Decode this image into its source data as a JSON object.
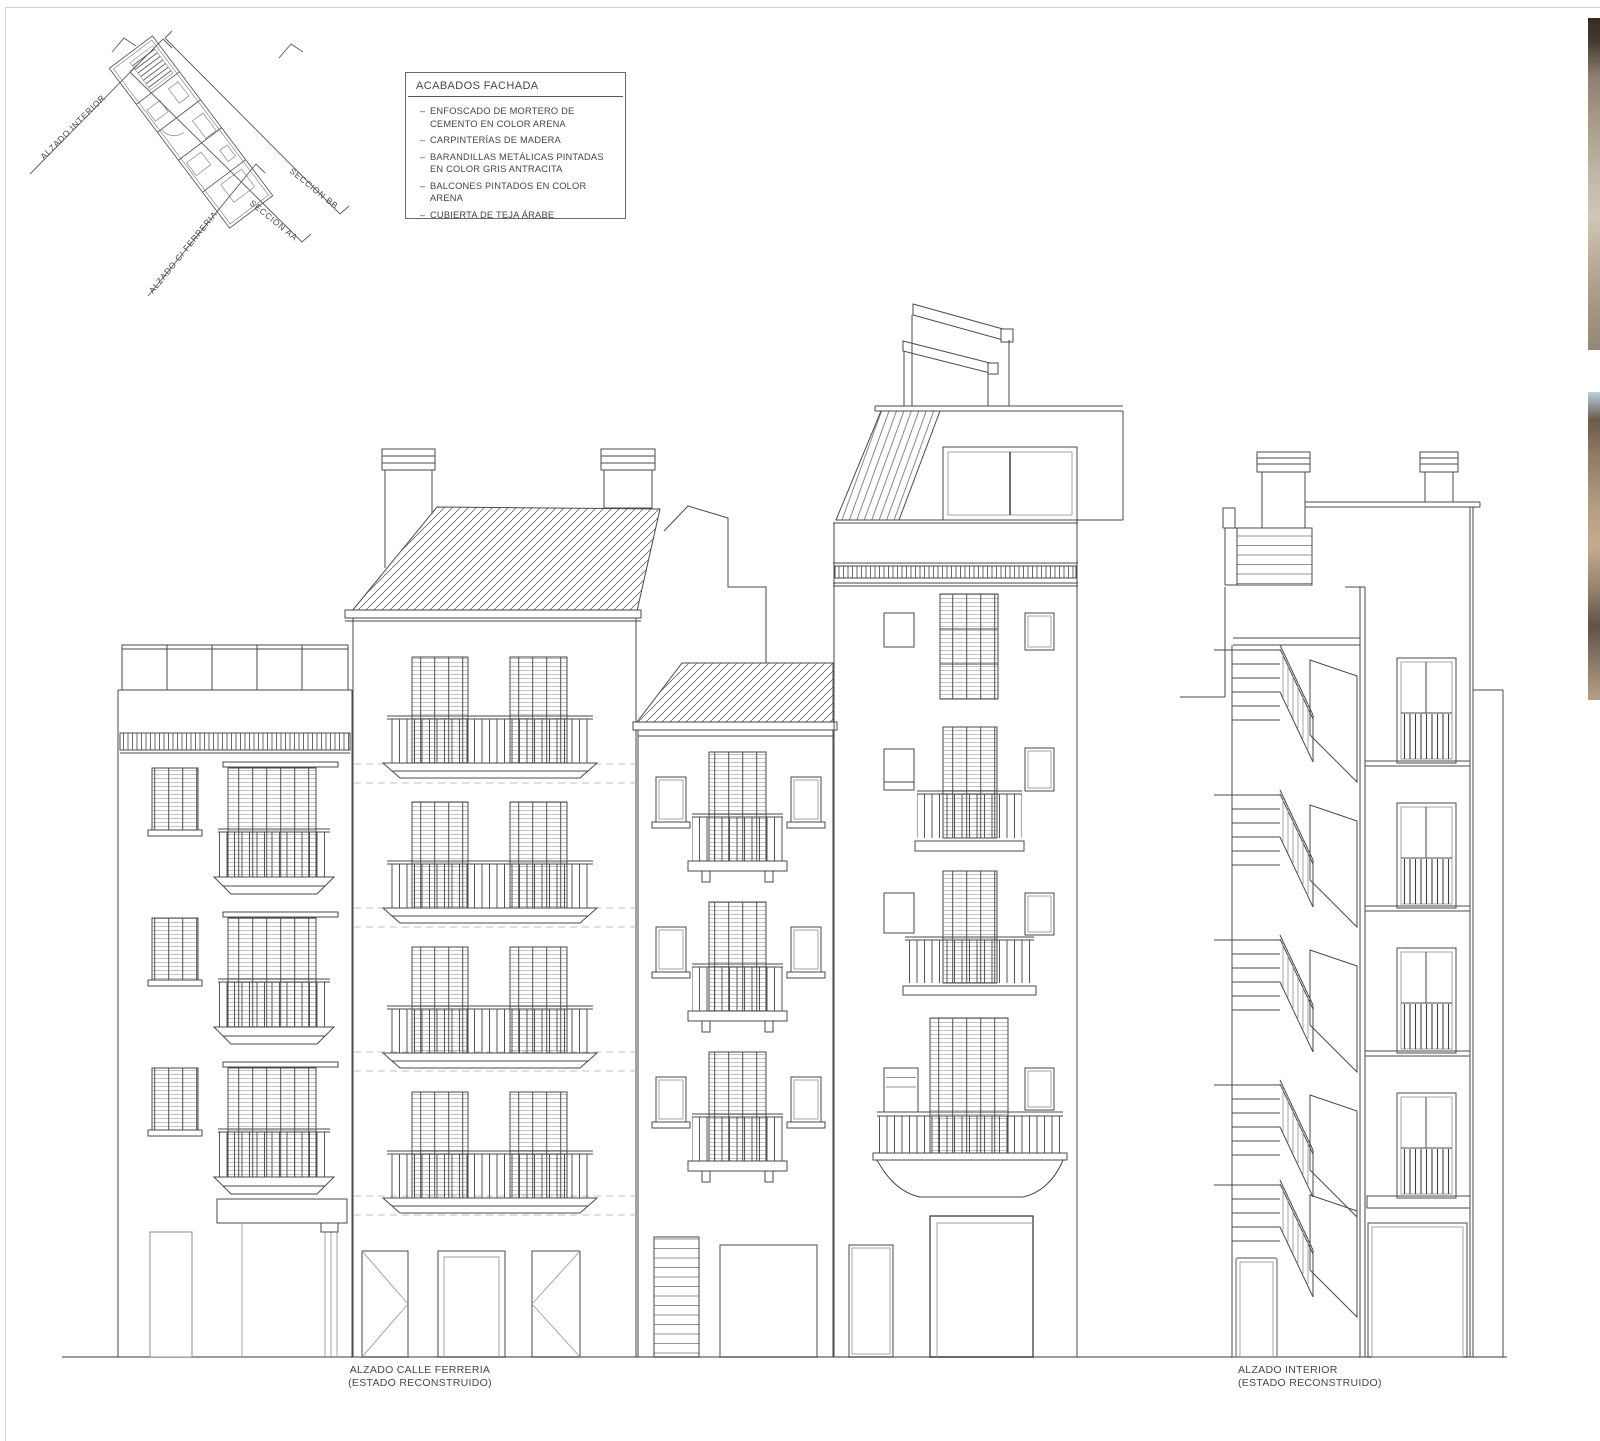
{
  "sheet": {
    "keyplan": {
      "labels": {
        "alzado_interior": "ALZADO INTERIOR",
        "alzado_calle": "ALZADO C/ FERRERIA",
        "seccion_aa": "SECCION AA",
        "seccion_bb": "SECCION BB"
      }
    },
    "legend": {
      "title": "ACABADOS FACHADA",
      "items": [
        {
          "l1": "ENFOSCADO DE MORTERO DE",
          "l2": "CEMENTO EN COLOR ARENA"
        },
        {
          "l1": "CARPINTERÍAS DE MADERA",
          "l2": ""
        },
        {
          "l1": "BARANDILLAS METÁLICAS PINTADAS",
          "l2": "EN COLOR GRIS ANTRACITA"
        },
        {
          "l1": "BALCONES PINTADOS EN COLOR ARENA",
          "l2": ""
        },
        {
          "l1": "CUBIERTA DE TEJA ÁRABE",
          "l2": ""
        }
      ]
    },
    "captions": {
      "left": {
        "line1": "ALZADO CALLE FERRERIA",
        "line2": "(ESTADO RECONSTRUIDO)"
      },
      "right": {
        "line1": "ALZADO INTERIOR",
        "line2": "(ESTADO RECONSTRUIDO)"
      }
    },
    "colors": {
      "paper": "#ffffff",
      "line": "#4a4a4a",
      "line_light": "#9b9b9b",
      "dashed": "#c2c2c2",
      "text": "#474747",
      "border": "#d2d2d2"
    }
  }
}
